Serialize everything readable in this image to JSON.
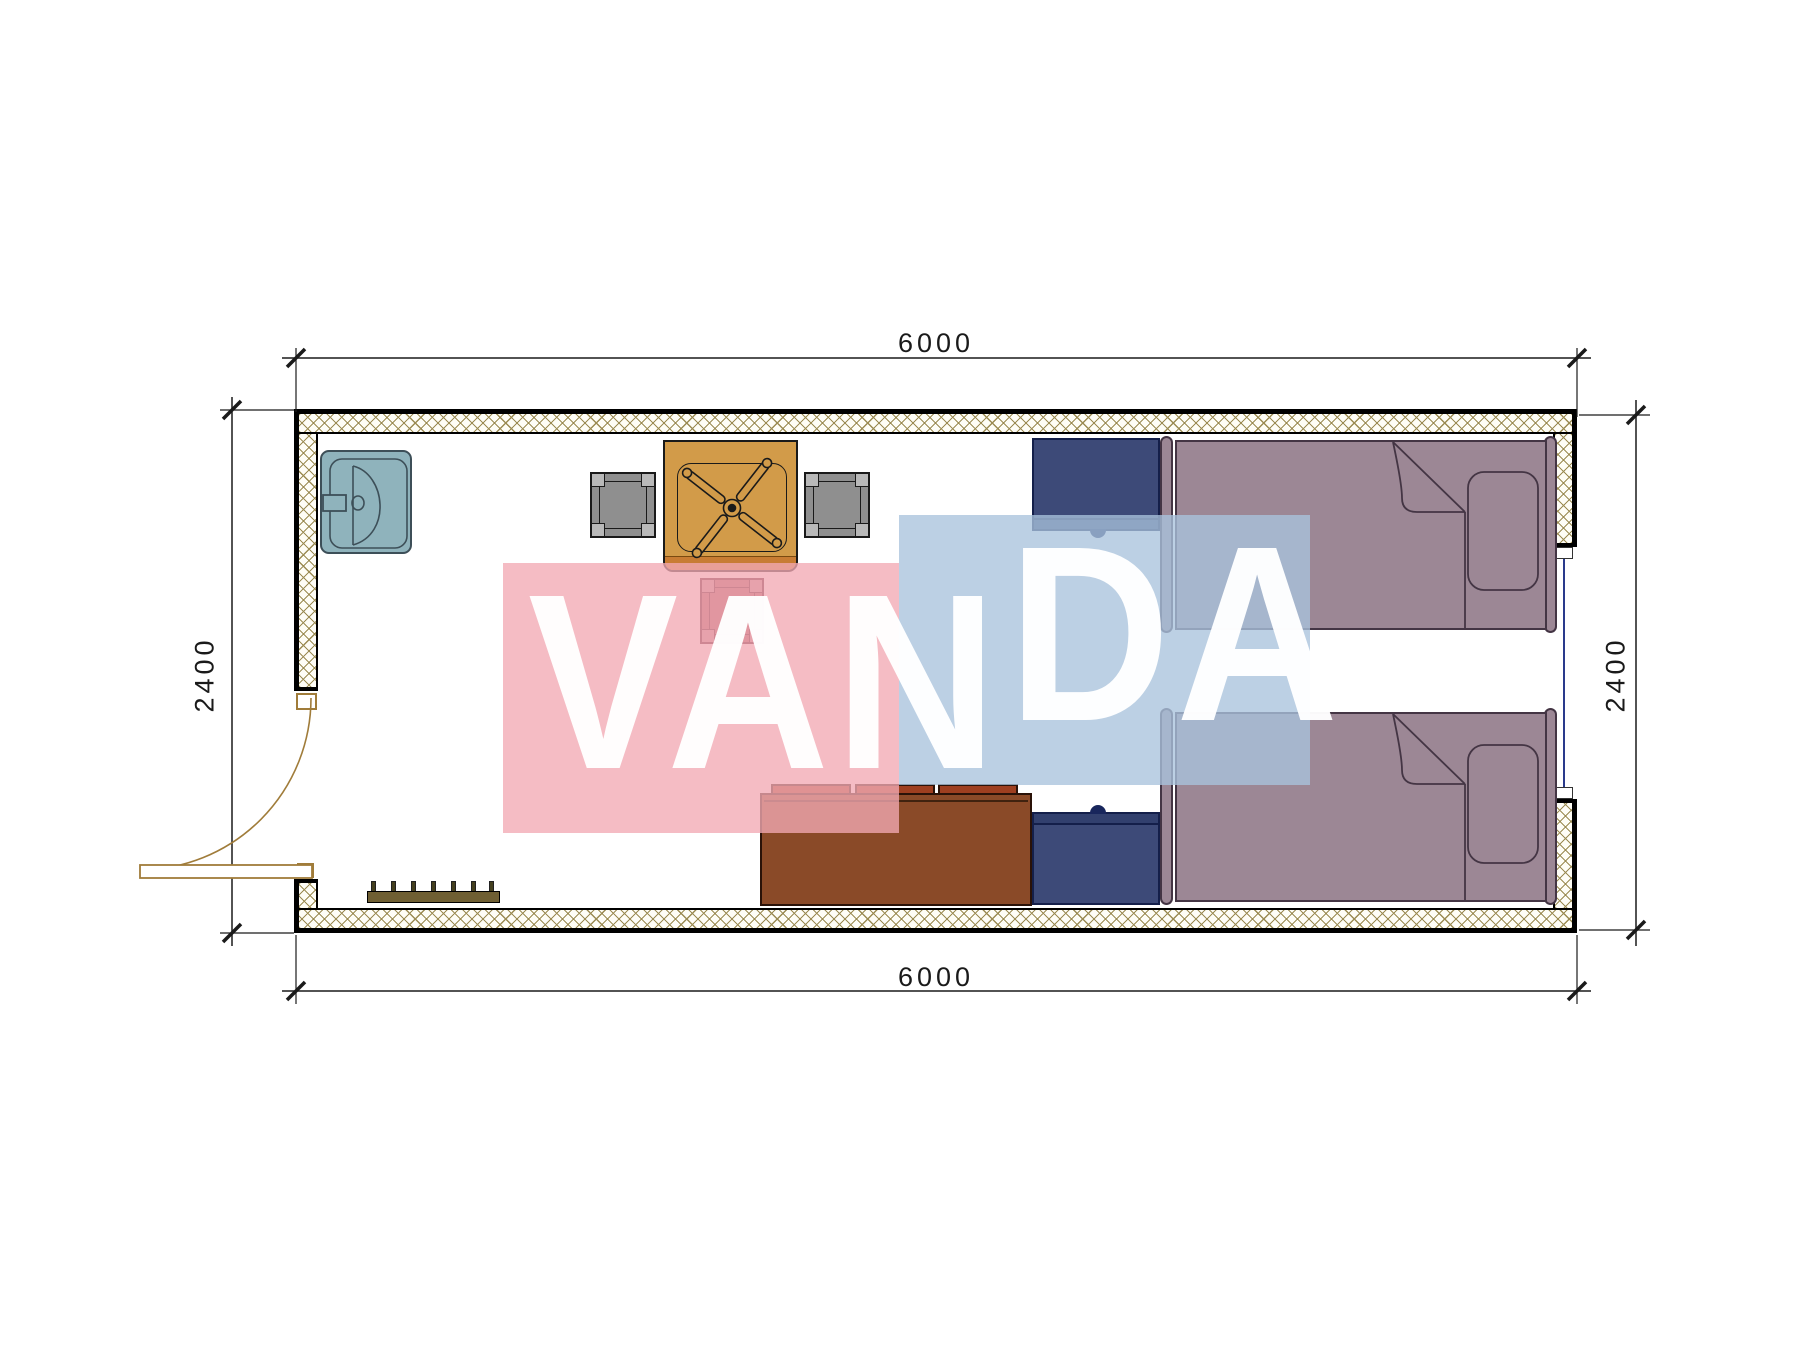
{
  "drawing": {
    "type": "floor-plan",
    "room_width_mm": "6000",
    "room_depth_mm": "2400"
  },
  "dimensions": {
    "top_label": "6000",
    "bottom_label": "6000",
    "left_label": "2400",
    "right_label": "2400"
  },
  "watermark": {
    "part1": "VAN",
    "part2": "DA"
  },
  "colors": {
    "wall_hatch": "#9b8b53",
    "sink": "#8fb3bc",
    "table": "#d29b49",
    "table_accent": "#c87c33",
    "stool_gray": "#8f8f8f",
    "stool_red": "#a4525c",
    "nightstand": "#3d4a78",
    "bed": "#9c8795",
    "sofa": "#8a4a28",
    "cushion": "#9e3f20",
    "rack": "#6f5f33",
    "door_line": "#a07c3a",
    "glazing": "#2a3a8c",
    "dim_line": "#1a1a1a",
    "wm_pink": "#f2a9b4",
    "wm_blue": "#a9c3dd"
  },
  "furniture": [
    {
      "name": "wash-basin"
    },
    {
      "name": "square-table-with-fan"
    },
    {
      "name": "stool-gray-left"
    },
    {
      "name": "stool-gray-right"
    },
    {
      "name": "stool-red"
    },
    {
      "name": "nightstand-top"
    },
    {
      "name": "nightstand-bottom"
    },
    {
      "name": "single-bed-top"
    },
    {
      "name": "single-bed-bottom"
    },
    {
      "name": "sofa"
    },
    {
      "name": "coat-rack"
    }
  ]
}
